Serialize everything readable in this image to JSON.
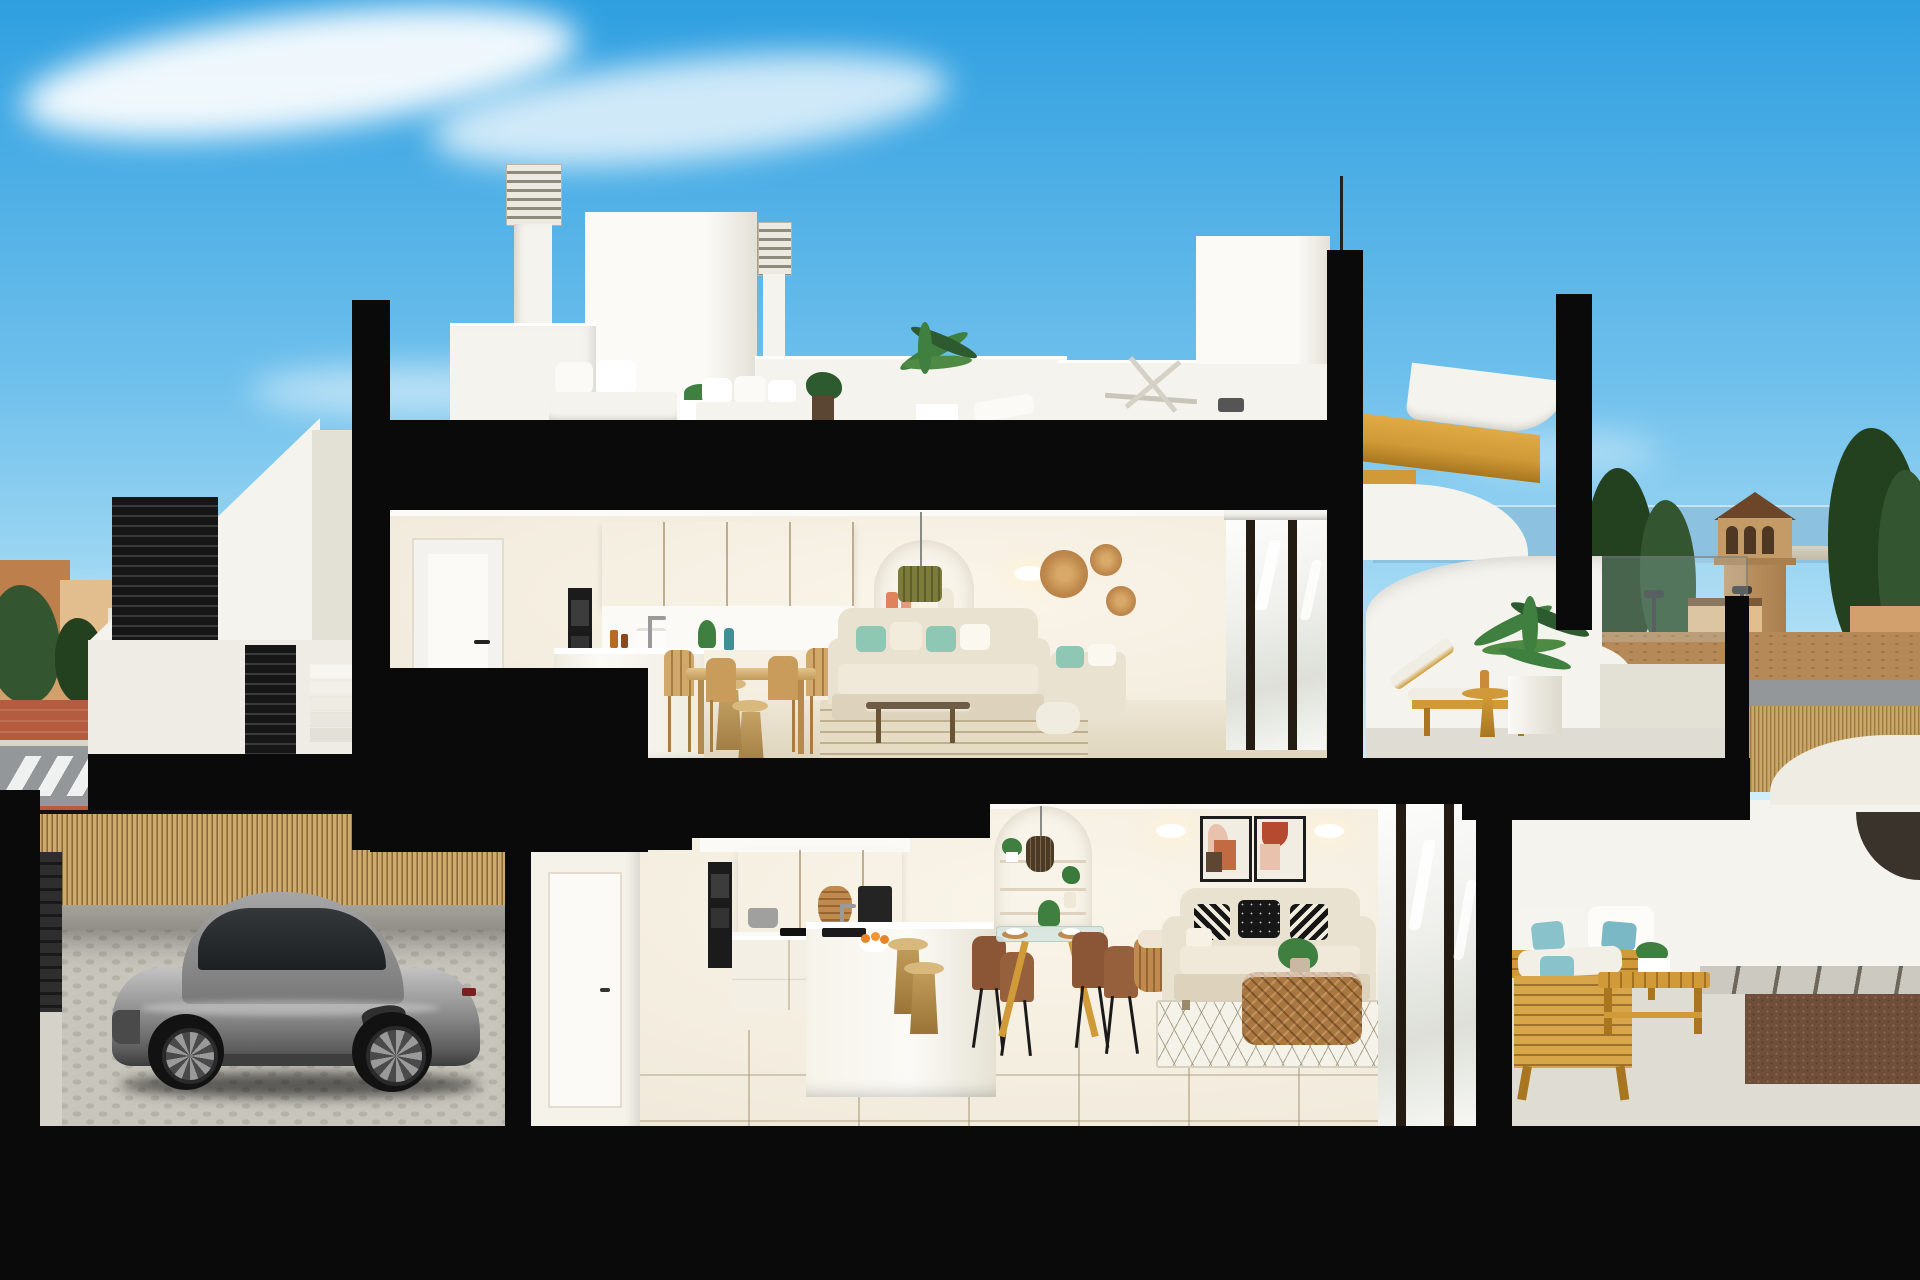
{
  "scene": {
    "type": "3d-architectural-cross-section-render",
    "description": "Sunny cross-section rendering of a modern white Mediterranean duplex: rooftop solarium with chimneys and outdoor lounge, upper apartment with kitchen, dining and living room plus terrace with sun lounger and palm, lower apartment with kitchen, dining and living room plus timber patio lounge, and a garage with a silver sports car; town, trees, sea and a watchtower in the backdrop",
    "areas": [
      "sky",
      "town-backdrop",
      "rooftop-solarium",
      "upper-apartment",
      "upper-terrace",
      "lower-apartment",
      "lower-terrace",
      "garage",
      "street"
    ]
  },
  "palette": {
    "sky_top": "#2f9fe0",
    "sky_mid": "#6fc0ec",
    "sky_low": "#b5e2f6",
    "cloud": "#ffffff",
    "cut": "#0a0a0a",
    "ext": "#f5f3ed",
    "ext_shade": "#e3e0d6",
    "white_soft": "#fbfaf6",
    "int_wall": "#f0e9da",
    "int_lit": "#faf5e9",
    "wood": "#d9b87c",
    "wood_dark": "#c09a58",
    "oven": "#1b1b1b",
    "floor_up": "#e9e1cd",
    "floor_low": "#e7dfca",
    "tile_line": "#cfc4a8",
    "sofa": "#eae2d1",
    "sofa_dark": "#ddd3bd",
    "teal": "#8ec7b3",
    "aqua": "#8ac2cc",
    "rug_up": "#e6dcc4",
    "rug_low": "#f5f2ea",
    "rattan": "#aa7740",
    "basket": "#c08a4e",
    "green": "#3f7f3f",
    "green_dark": "#2d5a2e",
    "pendant": "#7b7c3c",
    "terracotta": "#c26a42",
    "rust": "#b54a30",
    "blush": "#e8c2ac",
    "frame_dark": "#1c1c1c",
    "glass_frame": "#241c12",
    "gold": "#cf9a37",
    "gold_dark": "#a8761f",
    "car_hi": "#c2c2c2",
    "car_mid": "#8f8f8f",
    "car_low": "#5f5f5f",
    "bamboo_a": "#cdab6e",
    "bamboo_b": "#a9854b",
    "cobble": "#c8c5bc",
    "cobble_dot": "#b5b2a8",
    "gate": "#262626",
    "town_a": "#d2a06c",
    "town_b": "#bd7f4c",
    "town_c": "#e2bd8e",
    "town_white": "#e9e5db",
    "tree": "#335631",
    "tree_dark": "#24411f",
    "sea": "#8cc2df",
    "road": "#93979a",
    "walkway": "#b55c40",
    "curb": "#d8d5cc",
    "dirt": "#b68a58",
    "tower": "#c49a66",
    "tower_roof": "#6d4529",
    "terrace_floor": "#dfdcd3",
    "gravel": "#6f4f3a",
    "paver": "#ccc9c0"
  }
}
